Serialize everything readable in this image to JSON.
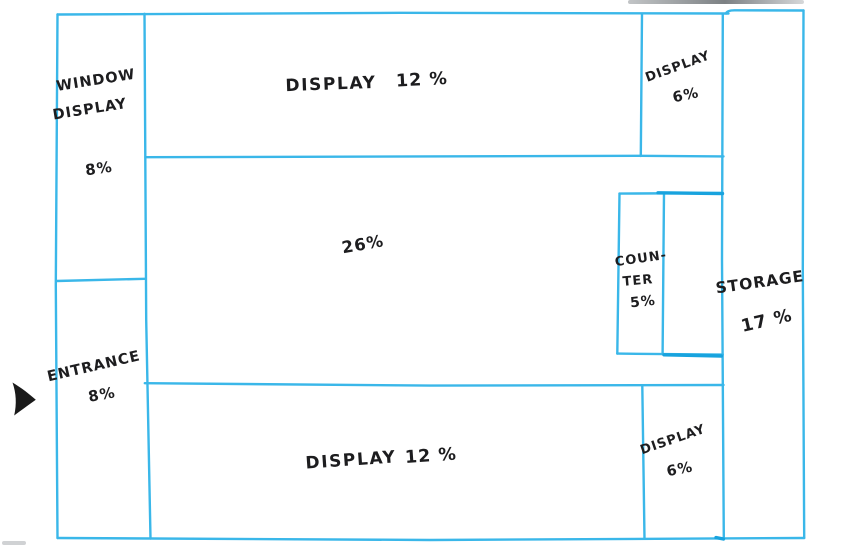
{
  "colors": {
    "wall": "#3ab7e9",
    "wall_dark": "#18a3de",
    "ink": "#1d1d1f",
    "arrow": "#1a1a1a",
    "background": "#ffffff"
  },
  "floor_plan": {
    "areas": {
      "window_display": {
        "name_line1": "WINDOW",
        "name_line2": "DISPLAY",
        "share": "8%"
      },
      "entrance": {
        "name": "ENTRANCE",
        "share": "8%"
      },
      "display_top": {
        "name": "DISPLAY",
        "share": "12 %"
      },
      "display_top_right": {
        "name": "DISPLAY",
        "share": "6%"
      },
      "open_floor": {
        "share": "26%"
      },
      "counter": {
        "name_line1": "COUN-",
        "name_line2": "TER",
        "share": "5%"
      },
      "storage": {
        "name": "STORAGE",
        "share": "17 %"
      },
      "display_bottom": {
        "name": "DISPLAY",
        "share": "12 %"
      },
      "display_bottom_right": {
        "name": "DISPLAY",
        "share": "6%"
      }
    }
  }
}
